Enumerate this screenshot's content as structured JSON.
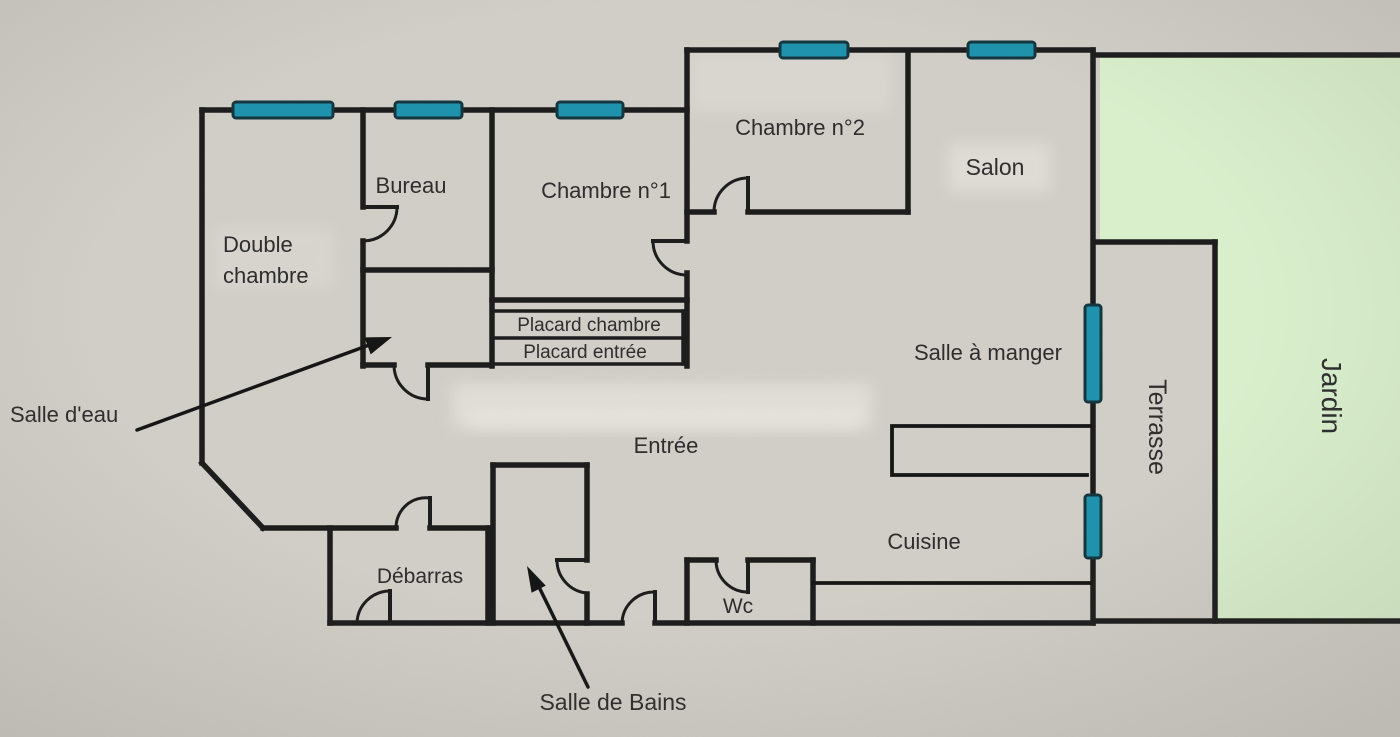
{
  "floorplan": {
    "labels": {
      "double_chambre_line1": "Double",
      "double_chambre_line2": "chambre",
      "bureau": "Bureau",
      "chambre1": "Chambre n°1",
      "chambre2": "Chambre n°2",
      "salon": "Salon",
      "salle_a_manger": "Salle à manger",
      "placard_chambre": "Placard chambre",
      "placard_entree": "Placard entrée",
      "entree": "Entrée",
      "salle_deau": "Salle d'eau",
      "debarras": "Débarras",
      "wc": "Wc",
      "cuisine": "Cuisine",
      "salle_de_bains": "Salle de Bains",
      "terrasse": "Terrasse",
      "jardin": "Jardin"
    },
    "colors": {
      "paper": "#d2cfc8",
      "wall": "#1d1d1d",
      "window_fill": "#1f93ad",
      "window_border": "#15363e",
      "garden_fill": "#d9efcc",
      "label_text": "#2e2e2e"
    }
  }
}
